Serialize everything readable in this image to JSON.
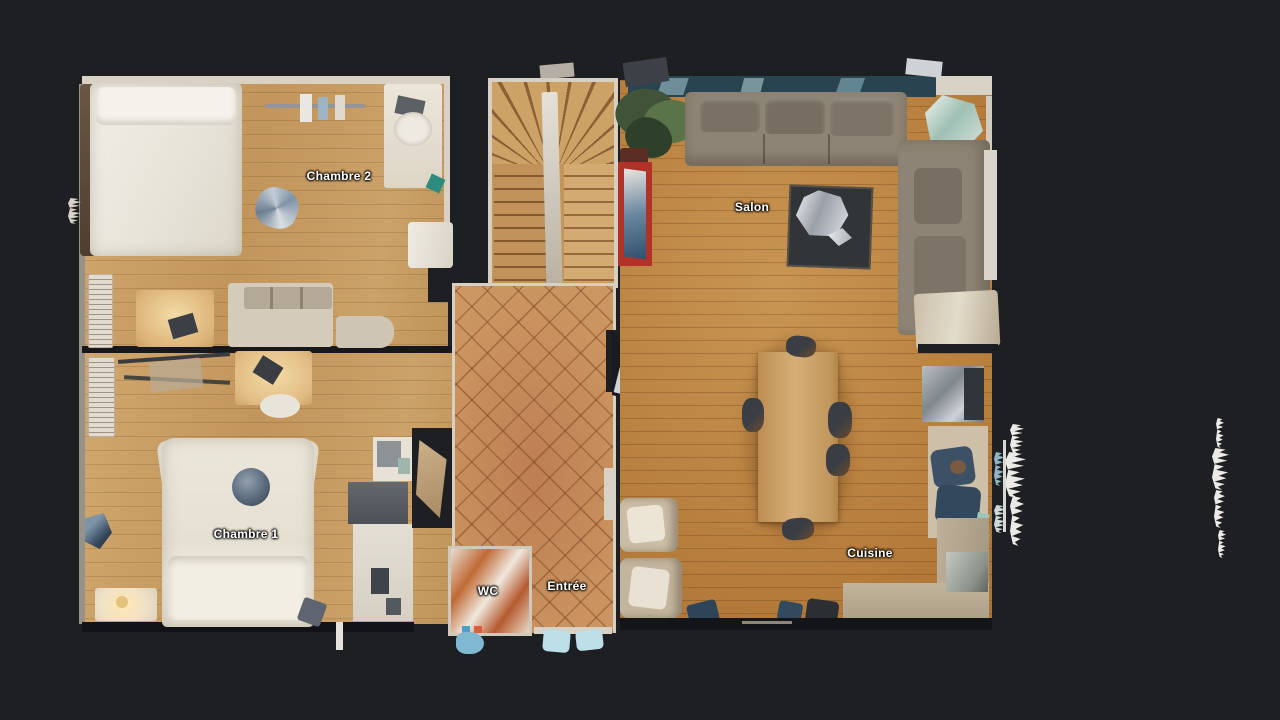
{
  "rooms": {
    "chambre2": {
      "label": "Chambre 2"
    },
    "chambre1": {
      "label": "Chambre 1"
    },
    "salon": {
      "label": "Salon"
    },
    "cuisine": {
      "label": "Cuisine"
    },
    "entree": {
      "label": "Entrée"
    },
    "wc": {
      "label": "WC"
    }
  },
  "colors": {
    "background": "#1d1f22",
    "label_text": "#ffffff",
    "wall_light": "#d9d2c4",
    "wood_bedrooms": "#c8a067",
    "wood_salon": "#b67d3c",
    "tile_entrance": "#c9925f",
    "stair_wood": "#c1925a",
    "sofa_gray": "#8e8475",
    "bed_white": "#eae6db",
    "coffee_table": "#323537",
    "red_shelf": "#b23229",
    "plant_green": "#4c5f3e",
    "kitchen_counter": "#b5a88f",
    "appliance_steel": "#a8aeb2",
    "accent_blue": "#3c5166",
    "doormat_blue": "#bcdfe8",
    "lamp_glow": "#f3dba6"
  }
}
